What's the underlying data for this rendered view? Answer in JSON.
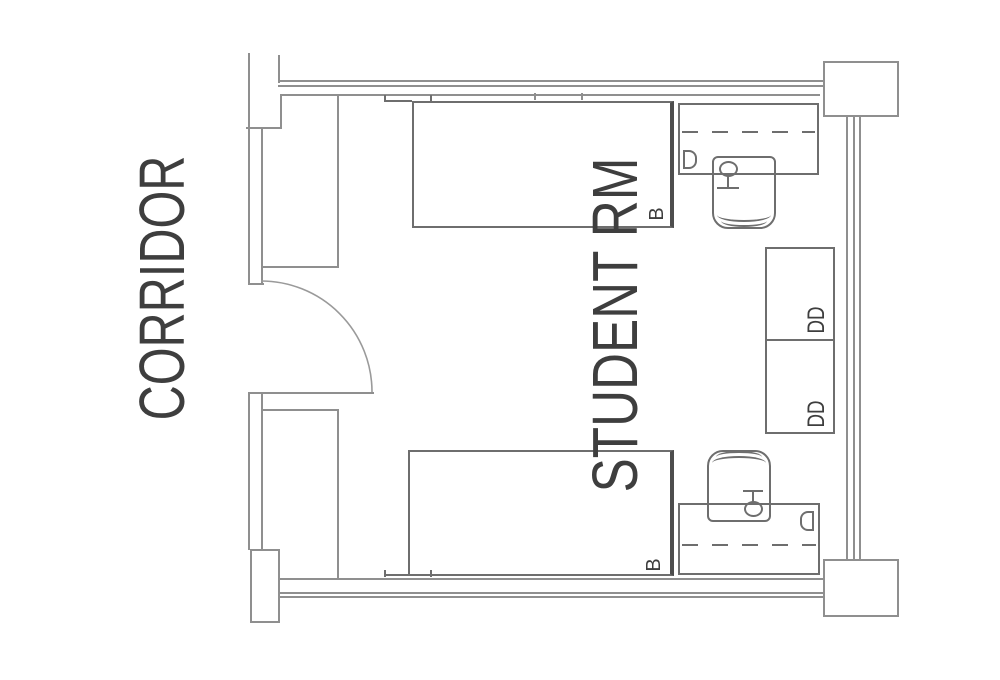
{
  "diagram": {
    "corridor_label": "CORRIDOR",
    "room_label": "STUDENT RM",
    "bed_labels": [
      "B",
      "B"
    ],
    "dresser_labels": [
      "DD",
      "DD"
    ],
    "colors": {
      "background": "#ffffff",
      "wall_line": "#8f8f8f",
      "furniture_line": "#6e6e6e",
      "text": "#3e3e3e"
    }
  }
}
